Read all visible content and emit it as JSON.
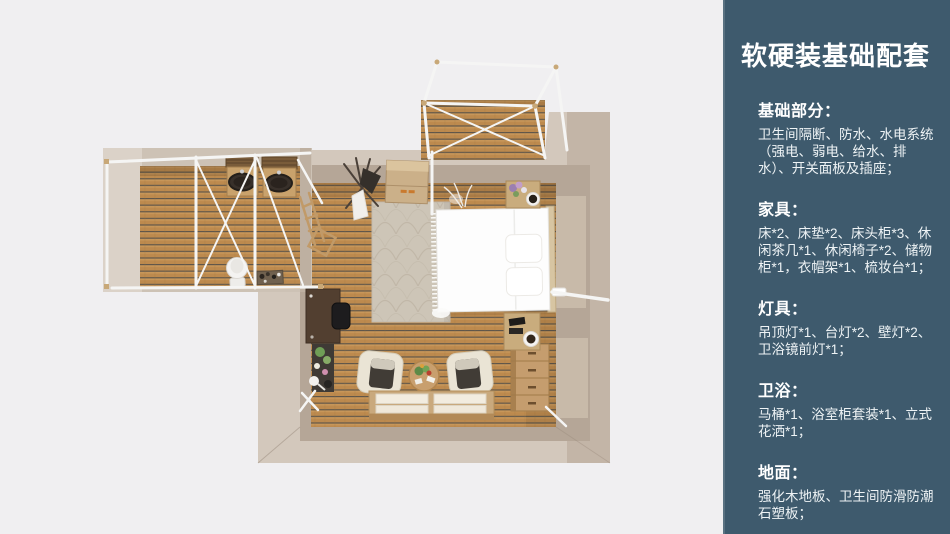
{
  "page": {
    "background": "#f0eff1"
  },
  "sidebar": {
    "background": "#3e5a6d",
    "text_color": "#eef3f5",
    "title": "软硬装基础配套",
    "sections": [
      {
        "heading": "基础部分：",
        "body": "卫生间隔断、防水、水电系统（强电、弱电、给水、排水）、开关面板及插座；"
      },
      {
        "heading": "家具：",
        "body": "床*2、床垫*2、床头柜*3、休闲茶几*1、休闲椅子*2、储物柜*1，衣帽架*1、梳妆台*1；"
      },
      {
        "heading": "灯具：",
        "body": "吊顶灯*1、台灯*2、壁灯*2、卫浴镜前灯*1；"
      },
      {
        "heading": "卫浴：",
        "body": "马桶*1、浴室柜套装*1、立式花洒*1；"
      },
      {
        "heading": "地面：",
        "body": "强化木地板、卫生间防滑防潮石塑板；"
      }
    ]
  },
  "floorplan": {
    "view": "top-down 3D render of a guest-room suite with attached bathroom wing and front deck canopy",
    "colors": {
      "floor_wood": "#bd8a4e",
      "floor_gap": "#5d554a",
      "wall_light": "#d3c8bc",
      "wall_dark": "#b5a697",
      "frame_white": "#f5f5f4",
      "bed_white": "#fdfdfd",
      "rug": "#cdc5b7",
      "wood_furniture": "#c9a877"
    }
  }
}
